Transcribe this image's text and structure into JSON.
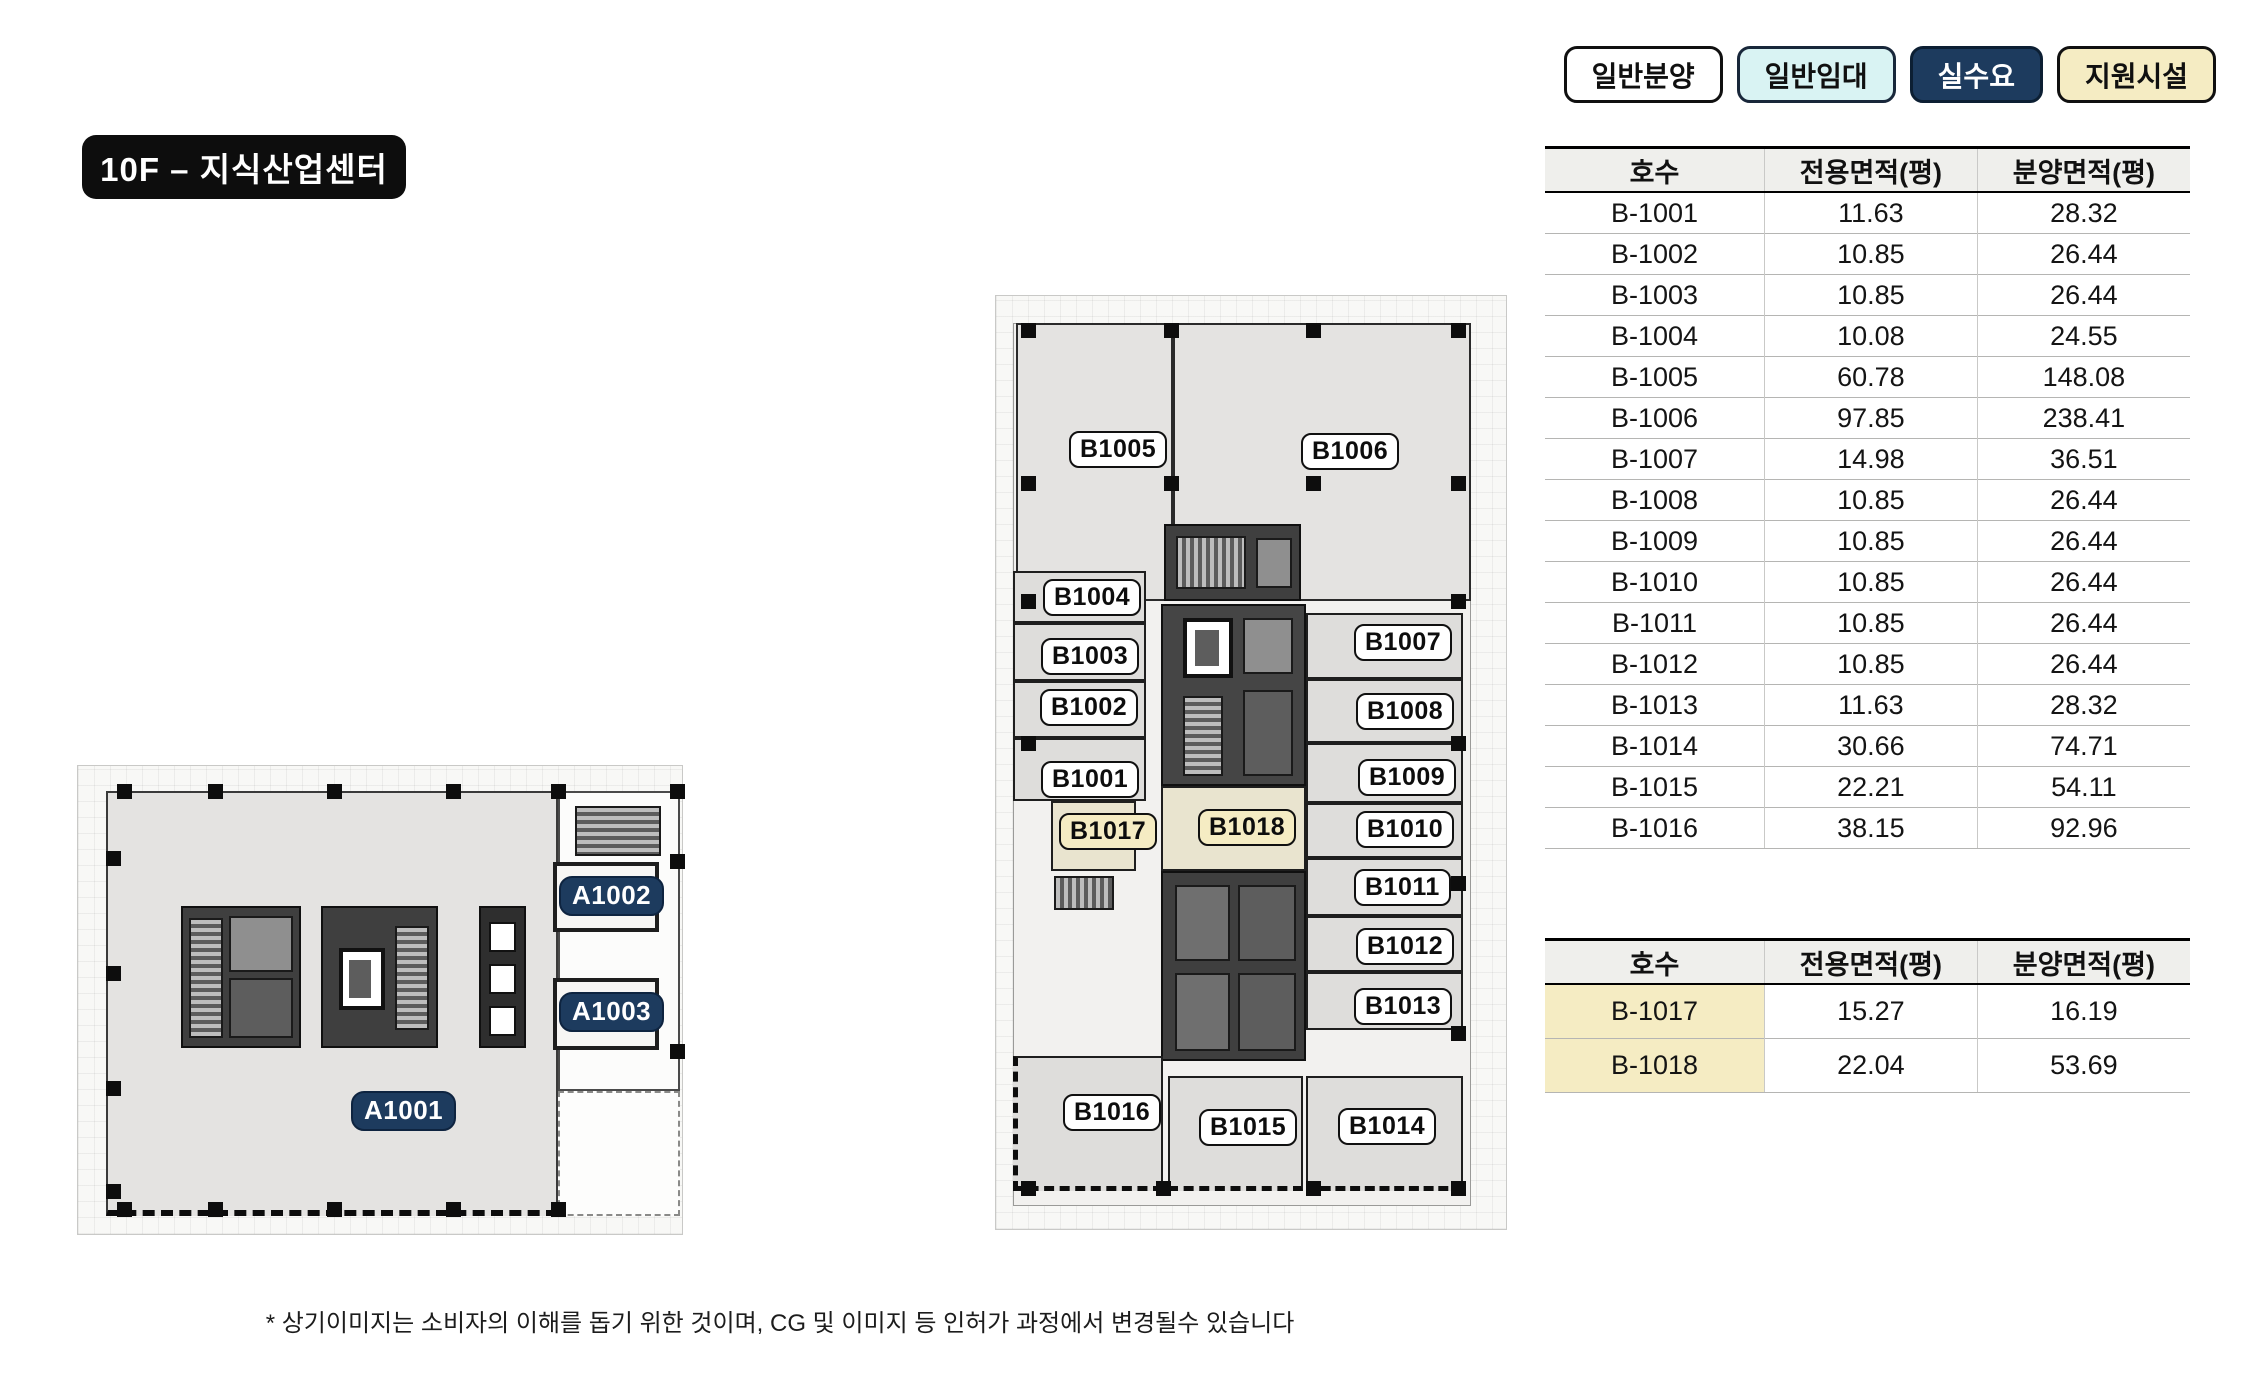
{
  "title": "10F – 지식산업센터",
  "legend": {
    "items": [
      {
        "label": "일반분양",
        "type": "general-sale"
      },
      {
        "label": "일반임대",
        "type": "general-lease"
      },
      {
        "label": "실수요",
        "type": "owner-use"
      },
      {
        "label": "지원시설",
        "type": "support-facility"
      }
    ]
  },
  "colors": {
    "navy": "#1d3b5e",
    "cream": "#f5ecc3",
    "cyan": "#d9f3f3",
    "table_header_bg": "#efefec"
  },
  "tables": {
    "main": {
      "headers": [
        "호수",
        "전용면적(평)",
        "분양면적(평)"
      ],
      "rows": [
        [
          "B-1001",
          "11.63",
          "28.32"
        ],
        [
          "B-1002",
          "10.85",
          "26.44"
        ],
        [
          "B-1003",
          "10.85",
          "26.44"
        ],
        [
          "B-1004",
          "10.08",
          "24.55"
        ],
        [
          "B-1005",
          "60.78",
          "148.08"
        ],
        [
          "B-1006",
          "97.85",
          "238.41"
        ],
        [
          "B-1007",
          "14.98",
          "36.51"
        ],
        [
          "B-1008",
          "10.85",
          "26.44"
        ],
        [
          "B-1009",
          "10.85",
          "26.44"
        ],
        [
          "B-1010",
          "10.85",
          "26.44"
        ],
        [
          "B-1011",
          "10.85",
          "26.44"
        ],
        [
          "B-1012",
          "10.85",
          "26.44"
        ],
        [
          "B-1013",
          "11.63",
          "28.32"
        ],
        [
          "B-1014",
          "30.66",
          "74.71"
        ],
        [
          "B-1015",
          "22.21",
          "54.11"
        ],
        [
          "B-1016",
          "38.15",
          "92.96"
        ]
      ]
    },
    "support": {
      "headers": [
        "호수",
        "전용면적(평)",
        "분양면적(평)"
      ],
      "highlight_first_cell": true,
      "rows": [
        [
          "B-1017",
          "15.27",
          "16.19"
        ],
        [
          "B-1018",
          "22.04",
          "53.69"
        ]
      ]
    }
  },
  "plan_a": {
    "labels": [
      {
        "text": "A1001"
      },
      {
        "text": "A1002"
      },
      {
        "text": "A1003"
      }
    ]
  },
  "plan_b": {
    "labels": [
      {
        "text": "B1005"
      },
      {
        "text": "B1006"
      },
      {
        "text": "B1004"
      },
      {
        "text": "B1003"
      },
      {
        "text": "B1002"
      },
      {
        "text": "B1001"
      },
      {
        "text": "B1017"
      },
      {
        "text": "B1018"
      },
      {
        "text": "B1007"
      },
      {
        "text": "B1008"
      },
      {
        "text": "B1009"
      },
      {
        "text": "B1010"
      },
      {
        "text": "B1011"
      },
      {
        "text": "B1012"
      },
      {
        "text": "B1013"
      },
      {
        "text": "B1016"
      },
      {
        "text": "B1015"
      },
      {
        "text": "B1014"
      }
    ]
  },
  "disclaimer": "* 상기이미지는 소비자의 이해를 돕기 위한 것이며, CG 및 이미지 등 인허가 과정에서 변경될수 있습니다"
}
